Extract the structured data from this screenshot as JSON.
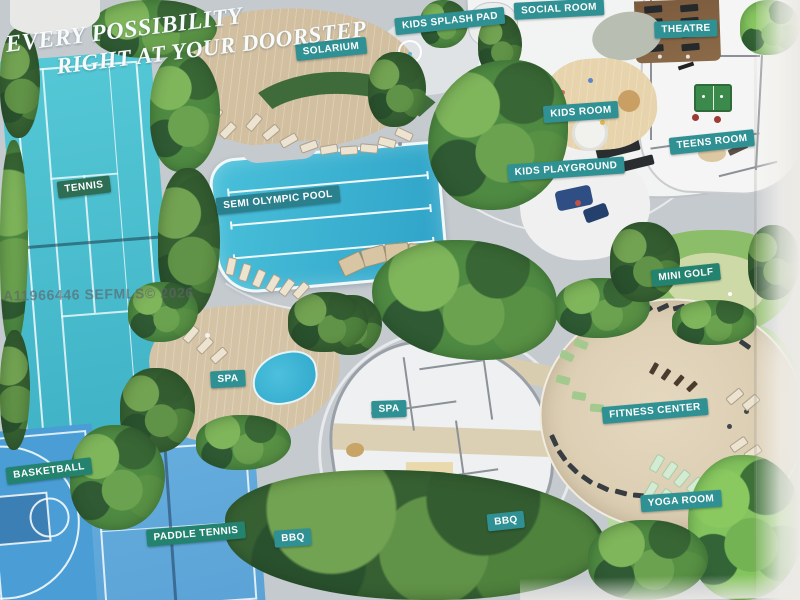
{
  "header": {
    "line1": "EVERY POSSIBILITY",
    "line2": "RIGHT AT YOUR DOORSTEP"
  },
  "watermark": "A11966446  SEFMLS© 2026",
  "labels": {
    "kids_splash_pad": "KIDS SPLASH PAD",
    "social_room": "SOCIAL ROOM",
    "theatre": "THEATRE",
    "solarium": "SOLARIUM",
    "kids_room": "KIDS ROOM",
    "teens_room": "TEENS ROOM",
    "kids_playground": "KIDS PLAYGROUND",
    "tennis": "TENNIS",
    "semi_olympic_pool": "SEMI OLYMPIC POOL",
    "mini_golf": "MINI GOLF",
    "spa_outdoor": "SPA",
    "spa_building": "SPA",
    "fitness_center": "FITNESS CENTER",
    "yoga_room": "YOGA ROOM",
    "basketball": "BASKETBALL",
    "paddle_tennis": "PADDLE TENNIS",
    "bbq_west": "BBQ",
    "bbq_east": "BBQ"
  },
  "palette": {
    "label_teal": "#2f9193",
    "label_deep_teal": "#2b808d",
    "label_dark_green": "#2e6e55",
    "label_green": "#23836f",
    "pool_blue": "#3eb3d6",
    "tennis_court": "#4fc3d4",
    "basketball_court": "#4a9fd4",
    "paddle_court": "#64abdc",
    "pavement": "#c5cacf",
    "deck_tan": "#cfbc9e",
    "lawn_green": "#a9cf8c",
    "tree_green": "#4f8a42",
    "title_text": "#f7fbfb"
  }
}
